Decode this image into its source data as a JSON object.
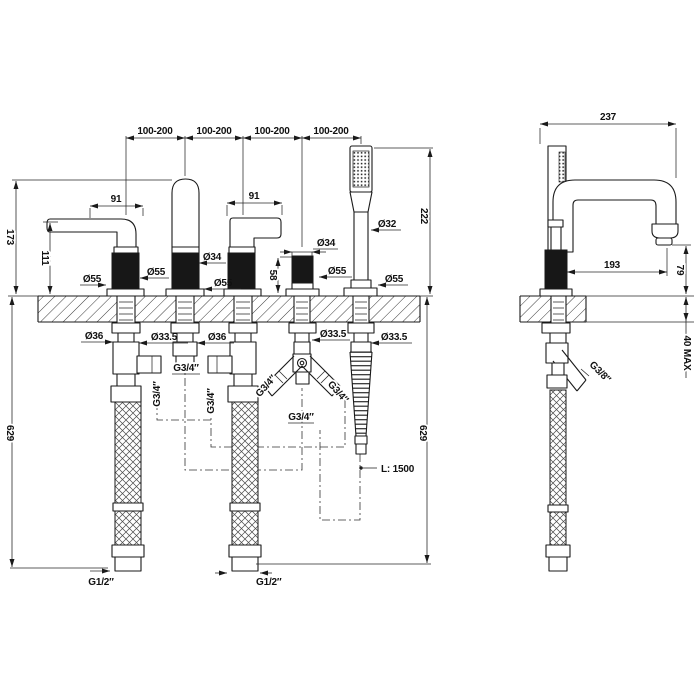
{
  "drawing": {
    "type": "technical-dimension-drawing",
    "subject": "5-hole deck-mounted bathtub faucet set with handshower, front and side views",
    "colors": {
      "line": "#1a1a1a",
      "dark_fill": "#171717",
      "background": "#ffffff"
    },
    "labels": {
      "spacing": "100-200",
      "lever_length": "91",
      "spout_height": "173",
      "handle_height": "111",
      "diverter_height": "58",
      "handshower_height": "222",
      "under_depth": "629",
      "dia_55": "Ø55",
      "dia_34": "Ø34",
      "dia_32": "Ø32",
      "dia_36": "Ø36",
      "dia_33_5": "Ø33.5",
      "g34": "G3/4″",
      "g12": "G1/2″",
      "g38": "G3/8″",
      "hose_length": "L: 1500",
      "side_width": "237",
      "spout_reach": "193",
      "outlet_height": "79",
      "deck_max": "40 MAX"
    }
  }
}
